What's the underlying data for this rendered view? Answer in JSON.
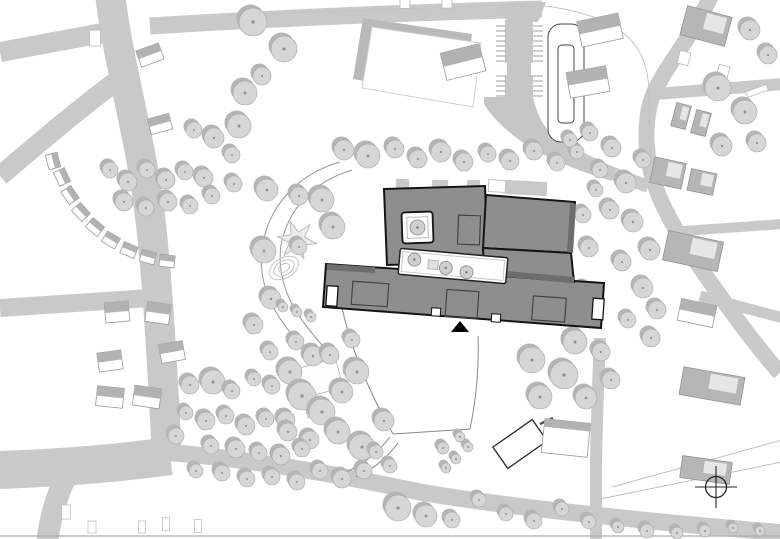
{
  "title": "architectural-site-plan",
  "canvas": {
    "w": 780,
    "h": 539,
    "bg": "#ffffff"
  },
  "palette": {
    "road": "#c9c9c9",
    "roadLight": "#c6c6c6",
    "treeFill": "#d6d6d6",
    "treeShadow": "#b5b5b5",
    "treeStroke": "#a6a6a6",
    "treeDot": "#8f8f8f",
    "school": "#8e8e8e",
    "schoolDark": "#6d6d6d",
    "outline": "#141414",
    "houseGray": "#b2b2b2",
    "houseStroke": "#9a9a9a",
    "bldgFill": "#b6b6b6",
    "bldgStroke": "#939393",
    "thin": "#c4c4c4",
    "mid": "#9f9f9f",
    "fieldShadow": "#b9b9b9",
    "white": "#ffffff",
    "dark": "#222222"
  },
  "roads": [
    {
      "d": "M110,-6 C118,60 138,130 148,200 C156,260 160,330 164,400 L167,458",
      "w": 30
    },
    {
      "d": "M0,52 L108,32",
      "w": 20
    },
    {
      "d": "M118,80 C80,108 40,142 0,176",
      "w": 20
    },
    {
      "d": "M150,298 L0,308",
      "w": 18
    },
    {
      "d": "M170,456 C120,463 60,468 -5,470",
      "w": 38
    },
    {
      "d": "M70,468 C58,492 50,515 47,545",
      "w": 22
    },
    {
      "d": "M150,26 C280,18 420,12 542,9",
      "w": 17
    },
    {
      "d": "M163,452 C250,459 330,473 420,492 C500,506 640,521 785,533",
      "w": 17
    },
    {
      "d": "M712,-6 C688,45 658,74 650,104 C643,134 646,164 659,196 C673,230 700,268 723,300 C746,332 762,353 780,373",
      "w": 16
    },
    {
      "d": "M656,94 L783,84",
      "w": 12
    },
    {
      "d": "M670,232 L783,224",
      "w": 10
    },
    {
      "d": "M700,296 L783,318",
      "w": 11
    },
    {
      "d": "M600,338 C598,380 597,420 596,460 L596,545",
      "w": 12
    },
    {
      "d": "M560,146 C585,162 610,174 648,186",
      "w": 13
    }
  ],
  "road_polys": [
    {
      "pts": "500,4 546,2 538,22 507,22"
    },
    {
      "pts": "505,20 533,20 533,98 505,98"
    },
    {
      "d": "M484,97 L533,97 C537,116 546,132 561,143 C575,152 590,159 606,165 L612,181 C585,173 558,163 535,150 C512,137 492,118 484,104 Z"
    }
  ],
  "parking": {
    "tick_ys": [
      26,
      31,
      36,
      41,
      46,
      51,
      56,
      61,
      76,
      81,
      86,
      91,
      96
    ],
    "left": [
      496,
      506
    ],
    "right": [
      533,
      543
    ],
    "gaps": [
      [
        500,
        63,
        7,
        12
      ],
      [
        531,
        63,
        7,
        12
      ]
    ]
  },
  "field": {
    "pts": "372,27 481,43 473,107 362,88",
    "shadow_dx": -9,
    "shadow_dy": -9
  },
  "loop": {
    "d": "M561,24 h10 a13,13 0 0 1 13,13 v92 a13,13 0 0 1 -13,13 h-10 a13,13 0 0 1 -13,-13 v-92 a13,13 0 0 1 13,-13 Z M562,45 h8 a4,4 0 0 1 4,4 v70 a4,4 0 0 1 -4,4 h-8 a4,4 0 0 1 -4,-4 v-70 a4,4 0 0 1 4,-4 Z"
  },
  "thin_lines": [
    {
      "d": "M228,15 L515,5",
      "c": "#c4c4c4",
      "w": 1
    },
    {
      "d": "M545,6 C622,16 648,44 649,92 L650,168",
      "c": "#c4c4c4",
      "w": 1
    },
    {
      "d": "M0,536 L780,536",
      "c": "#adadad",
      "w": 1.2
    },
    {
      "d": "M612,487 L782,440",
      "c": "#c0c0c0",
      "w": 1
    },
    {
      "d": "M600,499 L782,462",
      "c": "#c0c0c0",
      "w": 1
    },
    {
      "d": "M340,162 C295,175 268,208 262,248 C257,288 276,320 310,355",
      "c": "#999999",
      "w": 1
    },
    {
      "d": "M352,170 C312,182 288,210 281,245 C276,283 293,313 323,346",
      "c": "#999999",
      "w": 1
    },
    {
      "d": "M340,298 C348,340 365,385 393,434",
      "c": "#888888",
      "w": 1
    },
    {
      "d": "M393,434 L470,429",
      "c": "#888888",
      "w": 1
    },
    {
      "d": "M470,429 C477,395 479,362 478,336",
      "c": "#888888",
      "w": 1
    },
    {
      "d": "M390,437 C376,455 360,466 344,473",
      "c": "#888888",
      "w": 1
    },
    {
      "d": "M398,443 C386,459 372,470 356,477",
      "c": "#888888",
      "w": 1
    },
    {
      "d": "M540,424 L553,418",
      "c": "#555555",
      "w": 2.5
    }
  ],
  "playground": {
    "star": {
      "cx": 297,
      "cy": 240,
      "R": 20,
      "r": 8,
      "points": 6,
      "rot": 10
    },
    "contours": [
      [
        284,
        268,
        16,
        10
      ],
      [
        284,
        268,
        11,
        7
      ],
      [
        284,
        268,
        6,
        4
      ]
    ]
  },
  "terrace": {
    "w": 15,
    "h": 12,
    "items": [
      [
        53,
        161,
        75
      ],
      [
        62,
        177,
        65
      ],
      [
        70,
        195,
        56
      ],
      [
        81,
        212,
        47
      ],
      [
        95,
        227,
        39
      ],
      [
        111,
        240,
        31
      ],
      [
        129,
        250,
        23
      ],
      [
        148,
        257,
        15
      ],
      [
        167,
        261,
        7
      ]
    ]
  },
  "houses": [
    [
      150,
      55,
      24,
      17,
      -20
    ],
    [
      160,
      124,
      22,
      16,
      -15
    ],
    [
      463,
      62,
      40,
      28,
      -14
    ],
    [
      600,
      30,
      42,
      26,
      -12
    ],
    [
      588,
      82,
      40,
      26,
      -10
    ],
    [
      117,
      312,
      24,
      20,
      -5
    ],
    [
      158,
      313,
      24,
      20,
      8
    ],
    [
      110,
      361,
      24,
      19,
      -8
    ],
    [
      172,
      352,
      24,
      19,
      -10
    ],
    [
      110,
      397,
      27,
      20,
      6
    ],
    [
      147,
      397,
      27,
      20,
      8
    ],
    [
      697,
      313,
      36,
      22,
      12
    ]
  ],
  "outline_rects": [
    [
      95,
      38,
      11,
      16,
      0
    ],
    [
      684,
      58,
      11,
      13,
      15
    ],
    [
      723,
      72,
      11,
      13,
      15
    ],
    [
      757,
      91,
      22,
      6,
      -20
    ],
    [
      497,
      186,
      17,
      12,
      3
    ],
    [
      525,
      187,
      15,
      10,
      3
    ],
    [
      405,
      2,
      10,
      13,
      0
    ],
    [
      447,
      2,
      10,
      12,
      0
    ]
  ],
  "sheds": [
    [
      66,
      512,
      9,
      14,
      0
    ],
    [
      92,
      527,
      8,
      12,
      0
    ],
    [
      142,
      527,
      7,
      12,
      0
    ],
    [
      166,
      524,
      7,
      13,
      0
    ],
    [
      198,
      526,
      7,
      13,
      0
    ]
  ],
  "bldgs": [
    [
      706,
      26,
      46,
      30,
      15
    ],
    [
      681,
      116,
      15,
      24,
      15
    ],
    [
      701,
      123,
      15,
      24,
      15
    ],
    [
      668,
      173,
      32,
      26,
      12
    ],
    [
      702,
      182,
      26,
      22,
      12
    ],
    [
      693,
      251,
      56,
      30,
      12
    ],
    [
      712,
      386,
      62,
      28,
      10
    ],
    [
      706,
      470,
      50,
      22,
      8
    ]
  ],
  "white_diag_bldg": [
    520,
    444,
    48,
    26,
    -35
  ],
  "gray_roof_bldg": [
    566,
    438,
    46,
    34,
    6
  ],
  "pavilions": [
    [
      320,
      378,
      40,
      30,
      -15
    ],
    [
      314,
      409,
      16,
      14,
      -15
    ]
  ],
  "school": {
    "patches": [
      [
        396,
        179,
        13,
        11,
        2
      ],
      [
        432,
        180,
        16,
        12,
        2
      ],
      [
        467,
        180,
        13,
        10,
        2
      ],
      [
        505,
        181,
        42,
        14,
        3
      ]
    ],
    "blocks": [
      {
        "pts": "326,264 604,283 601,328 323,307"
      },
      {
        "pts": "384,189 485,186 488,262 387,265"
      },
      {
        "pts": "486,195 575,202 571,253 483,248"
      },
      {
        "pts": "483,248 571,253 574,282 484,274"
      }
    ],
    "shadows": [
      {
        "pts": "327,264 375,267 375,273 327,270"
      },
      {
        "pts": "484,269 574,277 574,283 484,275"
      },
      {
        "pts": "570,203 576,204 573,253 567,252"
      }
    ],
    "courtyard": {
      "cx": 417.5,
      "cy": 227.5,
      "w": 31,
      "h": 31,
      "rot": -2,
      "tree_r": 7.5
    },
    "strip": {
      "cx": 453,
      "cy": 266,
      "w": 108,
      "h": 26,
      "rot": 5,
      "trees": [
        [
          414,
          263,
          6.5
        ],
        [
          446,
          268.5,
          6.5
        ],
        [
          467,
          271,
          6.5
        ]
      ],
      "box": [
        428,
        262,
        10,
        9
      ]
    },
    "roof_rects": [
      [
        469,
        230,
        22,
        29,
        2
      ],
      [
        370,
        294,
        36,
        23,
        4
      ],
      [
        462,
        304,
        32,
        27,
        4
      ],
      [
        549,
        309,
        33,
        24,
        4
      ]
    ],
    "entrances": [
      [
        332,
        296,
        11,
        20,
        4
      ],
      [
        598,
        309,
        11,
        21,
        4
      ]
    ],
    "notches": [
      [
        436,
        312,
        9,
        8,
        4
      ],
      [
        496,
        318,
        9,
        8,
        4
      ]
    ],
    "triangle": "451,332 469,332 460,321"
  },
  "trees": [
    [
      253,
      22,
      14
    ],
    [
      284,
      49,
      13
    ],
    [
      262,
      76,
      9
    ],
    [
      245,
      93,
      12
    ],
    [
      239,
      126,
      12
    ],
    [
      214,
      138,
      10
    ],
    [
      194,
      130,
      8
    ],
    [
      232,
      155,
      8
    ],
    [
      344,
      150,
      10
    ],
    [
      368,
      156,
      12
    ],
    [
      395,
      149,
      9
    ],
    [
      418,
      159,
      9
    ],
    [
      441,
      152,
      10
    ],
    [
      464,
      162,
      9
    ],
    [
      488,
      154,
      8
    ],
    [
      510,
      161,
      9
    ],
    [
      534,
      151,
      9
    ],
    [
      557,
      163,
      8
    ],
    [
      577,
      152,
      7
    ],
    [
      110,
      170,
      8
    ],
    [
      128,
      182,
      9
    ],
    [
      147,
      170,
      8
    ],
    [
      166,
      180,
      9
    ],
    [
      185,
      172,
      8
    ],
    [
      204,
      178,
      9
    ],
    [
      124,
      202,
      9
    ],
    [
      146,
      208,
      8
    ],
    [
      168,
      202,
      9
    ],
    [
      190,
      206,
      8
    ],
    [
      212,
      196,
      8
    ],
    [
      234,
      184,
      8
    ],
    [
      267,
      190,
      11
    ],
    [
      299,
      196,
      9
    ],
    [
      322,
      200,
      12
    ],
    [
      333,
      227,
      12
    ],
    [
      264,
      251,
      12
    ],
    [
      299,
      247,
      8
    ],
    [
      271,
      299,
      10
    ],
    [
      254,
      325,
      9
    ],
    [
      283,
      307,
      5
    ],
    [
      297,
      312,
      5
    ],
    [
      311,
      317,
      5
    ],
    [
      570,
      140,
      7
    ],
    [
      590,
      133,
      8
    ],
    [
      612,
      148,
      9
    ],
    [
      600,
      170,
      8
    ],
    [
      626,
      183,
      10
    ],
    [
      643,
      160,
      8
    ],
    [
      610,
      210,
      9
    ],
    [
      633,
      222,
      10
    ],
    [
      650,
      250,
      10
    ],
    [
      622,
      262,
      9
    ],
    [
      643,
      288,
      10
    ],
    [
      657,
      310,
      9
    ],
    [
      628,
      320,
      8
    ],
    [
      651,
      338,
      9
    ],
    [
      596,
      190,
      7
    ],
    [
      718,
      88,
      13
    ],
    [
      745,
      112,
      12
    ],
    [
      722,
      146,
      10
    ],
    [
      757,
      143,
      9
    ],
    [
      750,
      30,
      10
    ],
    [
      768,
      55,
      9
    ],
    [
      583,
      215,
      8
    ],
    [
      589,
      248,
      9
    ],
    [
      584,
      290,
      8
    ],
    [
      590,
      320,
      8
    ],
    [
      532,
      360,
      13
    ],
    [
      564,
      375,
      14
    ],
    [
      540,
      397,
      12
    ],
    [
      586,
      398,
      11
    ],
    [
      575,
      342,
      12
    ],
    [
      601,
      352,
      9
    ],
    [
      611,
      380,
      9
    ],
    [
      296,
      342,
      8
    ],
    [
      313,
      356,
      10
    ],
    [
      290,
      372,
      12
    ],
    [
      302,
      396,
      14
    ],
    [
      322,
      412,
      13
    ],
    [
      342,
      392,
      11
    ],
    [
      357,
      372,
      12
    ],
    [
      338,
      432,
      12
    ],
    [
      362,
      447,
      13
    ],
    [
      384,
      421,
      10
    ],
    [
      310,
      440,
      9
    ],
    [
      286,
      420,
      9
    ],
    [
      270,
      352,
      8
    ],
    [
      330,
      355,
      9
    ],
    [
      352,
      340,
      8
    ],
    [
      190,
      385,
      9
    ],
    [
      213,
      382,
      12
    ],
    [
      232,
      391,
      8
    ],
    [
      254,
      379,
      7
    ],
    [
      272,
      386,
      8
    ],
    [
      186,
      413,
      7
    ],
    [
      206,
      421,
      9
    ],
    [
      226,
      416,
      8
    ],
    [
      246,
      426,
      9
    ],
    [
      266,
      419,
      8
    ],
    [
      288,
      432,
      9
    ],
    [
      211,
      446,
      8
    ],
    [
      236,
      449,
      9
    ],
    [
      259,
      453,
      8
    ],
    [
      281,
      456,
      9
    ],
    [
      302,
      449,
      8
    ],
    [
      196,
      471,
      7
    ],
    [
      222,
      473,
      8
    ],
    [
      247,
      479,
      8
    ],
    [
      272,
      477,
      8
    ],
    [
      297,
      482,
      8
    ],
    [
      320,
      471,
      8
    ],
    [
      342,
      479,
      9
    ],
    [
      364,
      471,
      8
    ],
    [
      176,
      436,
      8
    ],
    [
      398,
      508,
      13
    ],
    [
      426,
      516,
      11
    ],
    [
      452,
      520,
      8
    ],
    [
      479,
      500,
      7
    ],
    [
      506,
      514,
      7
    ],
    [
      534,
      521,
      8
    ],
    [
      562,
      509,
      7
    ],
    [
      589,
      522,
      7
    ],
    [
      618,
      527,
      6
    ],
    [
      647,
      531,
      7
    ],
    [
      677,
      533,
      6
    ],
    [
      705,
      531,
      6
    ],
    [
      733,
      528,
      5
    ],
    [
      760,
      531,
      5
    ],
    [
      443,
      448,
      6
    ],
    [
      456,
      459,
      5
    ],
    [
      446,
      468,
      5
    ],
    [
      468,
      447,
      5
    ],
    [
      460,
      437,
      5
    ],
    [
      390,
      466,
      7
    ],
    [
      376,
      452,
      7
    ]
  ],
  "north_symbol": {
    "cx": 716,
    "cy": 487,
    "r": 10.5,
    "arm": 21
  }
}
